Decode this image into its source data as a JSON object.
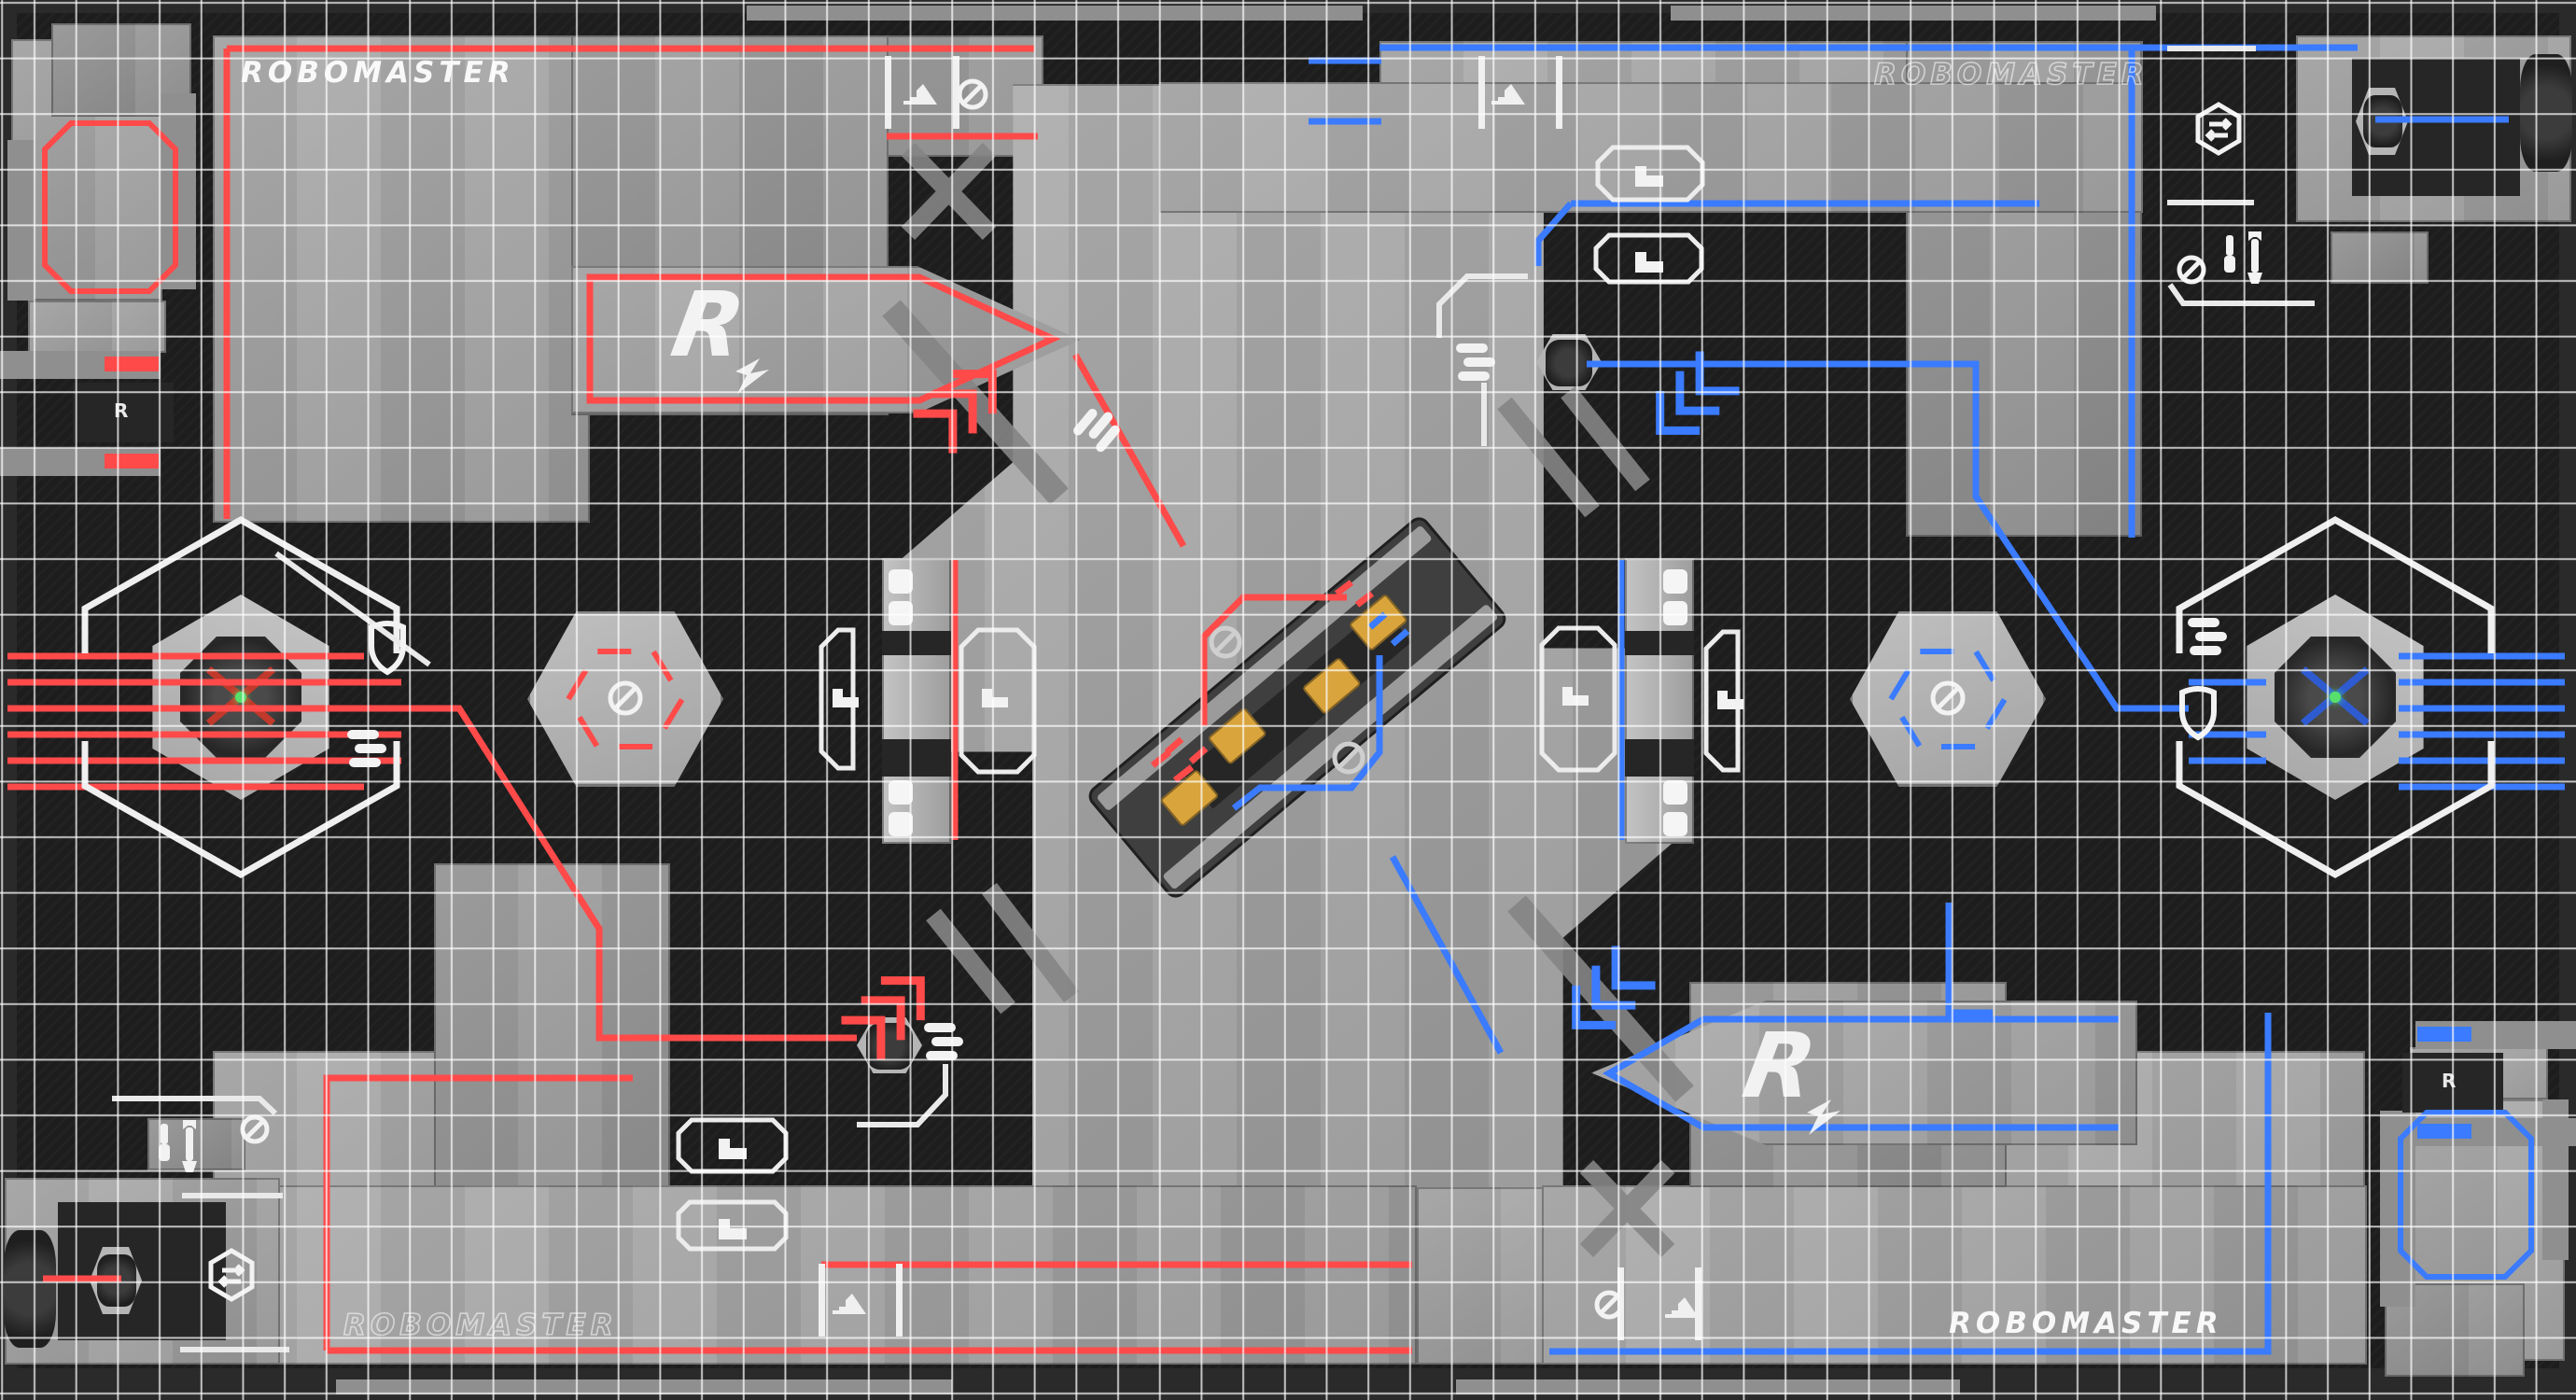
{
  "scene": {
    "name": "RoboMaster battlefield top-down view",
    "description": "Top view render of a RoboMaster arena: red team (left) vs blue team (right), white measurement grid overlay, central highland with rotating mechanism, outposts, ramps and base zones."
  },
  "branding": {
    "wordmark": "ROBOMASTER",
    "logo_letter": "R"
  },
  "wordmarks": {
    "top_left": {
      "text": "ROBOMASTER",
      "style": "solid",
      "team": "red"
    },
    "top_right": {
      "text": "ROBOMASTER",
      "style": "outline",
      "team": "blue"
    },
    "bottom_left": {
      "text": "ROBOMASTER",
      "style": "outline",
      "team": "red"
    },
    "bottom_right": {
      "text": "ROBOMASTER",
      "style": "solid",
      "team": "blue"
    }
  },
  "logos": {
    "red_ramp": "R",
    "blue_ramp": "R"
  },
  "supply": {
    "glyph": "R"
  },
  "colors": {
    "red": "#ff4a4a",
    "blue": "#3a7bff",
    "floor": "#1d1d1d",
    "concrete": "#a6a6a6",
    "grid_line": "#ffffff",
    "accent_green": "#57e06b",
    "armor_yellow": "#d9a43c"
  },
  "icons": [
    "shield-icon",
    "ammo-bullets-icon",
    "no-entry-icon",
    "repair-tools-icon",
    "exchange-station-icon",
    "slope-icon",
    "step-icon",
    "chevron-arrows-icon"
  ],
  "entities": {
    "red_outpost": "red outpost turret",
    "blue_outpost": "blue outpost turret",
    "central_mechanism": "central power mechanism",
    "red_sentry": "red sentry robot",
    "blue_sentry": "blue sentry robot",
    "red_base_robot": "red base robot",
    "blue_base_robot": "blue base robot"
  }
}
